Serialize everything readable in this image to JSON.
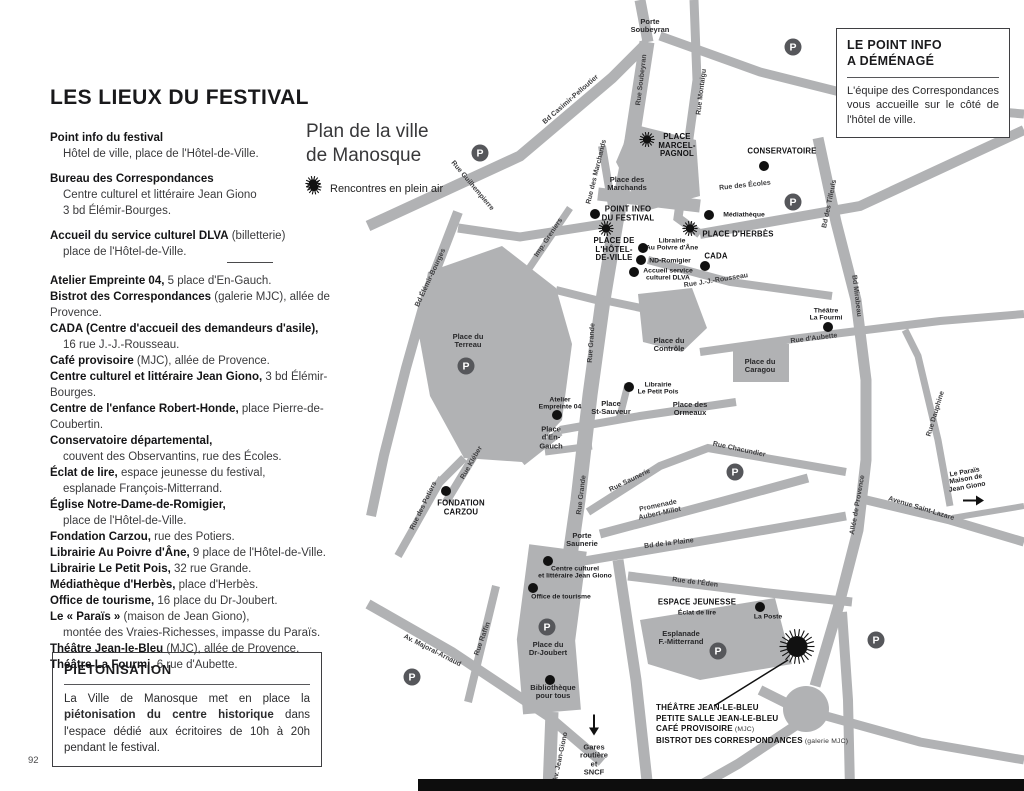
{
  "page": {
    "number": "92"
  },
  "left_column": {
    "title": "LES LIEUX DU FESTIVAL",
    "top_groups": [
      {
        "lines": [
          {
            "b": "Point info du festival",
            "r": ""
          },
          {
            "b": "",
            "r": "Hôtel de ville, place de l'Hôtel-de-Ville.",
            "indent": true
          }
        ]
      },
      {
        "lines": [
          {
            "b": "Bureau des Correspondances",
            "r": ""
          },
          {
            "b": "",
            "r": "Centre culturel et littéraire Jean Giono",
            "indent": true
          },
          {
            "b": "",
            "r": "3 bd Élémir-Bourges.",
            "indent": true
          }
        ]
      },
      {
        "lines": [
          {
            "b": "Accueil du service culturel DLVA",
            "r": " (billetterie)"
          },
          {
            "b": "",
            "r": "place de l'Hôtel-de-Ville.",
            "indent": true
          }
        ]
      }
    ],
    "venue_lines": [
      {
        "b": "Atelier Empreinte 04,",
        "r": " 5 place d'En-Gauch."
      },
      {
        "b": "Bistrot des Correspondances",
        "r": " (galerie MJC), allée de Provence."
      },
      {
        "b": "CADA (Centre d'accueil des demandeurs d'asile),",
        "r": ""
      },
      {
        "b": "",
        "r": "16 rue J.-J.-Rousseau.",
        "indent": true
      },
      {
        "b": "Café provisoire",
        "r": " (MJC), allée de Provence."
      },
      {
        "b": "Centre culturel et littéraire Jean Giono,",
        "r": " 3 bd Élémir-Bourges."
      },
      {
        "b": "Centre de l'enfance Robert-Honde,",
        "r": " place Pierre-de-Coubertin."
      },
      {
        "b": "Conservatoire départemental,",
        "r": ""
      },
      {
        "b": "",
        "r": "couvent des Observantins, rue des Écoles.",
        "indent": true
      },
      {
        "b": "Éclat de lire,",
        "r": " espace jeunesse du festival,"
      },
      {
        "b": "",
        "r": "esplanade François-Mitterrand.",
        "indent": true
      },
      {
        "b": "Église Notre-Dame-de-Romigier,",
        "r": ""
      },
      {
        "b": "",
        "r": "place de l'Hôtel-de-Ville.",
        "indent": true
      },
      {
        "b": "Fondation Carzou,",
        "r": " rue des Potiers."
      },
      {
        "b": "Librairie Au Poivre d'Âne,",
        "r": " 9 place de l'Hôtel-de-Ville."
      },
      {
        "b": "Librairie Le Petit Pois,",
        "r": " 32 rue Grande."
      },
      {
        "b": "Médiathèque d'Herbès,",
        "r": " place d'Herbès."
      },
      {
        "b": "Office de tourisme,",
        "r": " 16 place du Dr-Joubert."
      },
      {
        "b": "Le « Paraïs »",
        "r": " (maison de Jean Giono),"
      },
      {
        "b": "",
        "r": "montée des Vraies-Richesses, impasse du Paraïs.",
        "indent": true
      },
      {
        "b": "Théâtre Jean-le-Bleu",
        "r": " (MJC), allée de Provence."
      },
      {
        "b": "Théâtre La Fourmi,",
        "r": " 6 rue d'Aubette."
      }
    ]
  },
  "map_heading": {
    "title": "Plan de la ville\nde Manosque",
    "legend_label": "Rencontres en plein air"
  },
  "info_box": {
    "title": "LE POINT INFO\nA DÉMÉNAGÉ",
    "body": "L'équipe des Correspondances vous accueille sur le côté de l'hôtel de ville."
  },
  "pieton_box": {
    "title": "PIÉTONISATION",
    "body_pre": "La Ville de Manosque met en place la ",
    "body_bold": "piétonisation du centre historique",
    "body_post": " dans l'espace dédié aux écritoires de 10h à 20h pendant le festival."
  },
  "map": {
    "road_color": "#b1b2b4",
    "labels": [
      {
        "t": "Porte\nSoubeyran",
        "x": 650,
        "y": 26,
        "r": 0,
        "c": "place"
      },
      {
        "t": "Rue Soubeyran",
        "x": 642,
        "y": 80,
        "r": -83,
        "c": "street"
      },
      {
        "t": "Rue Montaigu",
        "x": 702,
        "y": 92,
        "r": -83,
        "c": "street"
      },
      {
        "t": "Bd Casimir-Pelloutier",
        "x": 571,
        "y": 100,
        "r": -41,
        "c": "street"
      },
      {
        "t": "Rue Guilhempierre",
        "x": 472,
        "y": 186,
        "r": 50,
        "c": "street"
      },
      {
        "t": "Rue des Marchands",
        "x": 597,
        "y": 172,
        "r": -76,
        "c": "street"
      },
      {
        "t": "Rue des Écoles",
        "x": 745,
        "y": 186,
        "r": -6,
        "c": "street"
      },
      {
        "t": "Imp. Greniers",
        "x": 549,
        "y": 238,
        "r": -56,
        "c": "street"
      },
      {
        "t": "Bd Élémir-Bourges",
        "x": 431,
        "y": 278,
        "r": -65,
        "c": "street"
      },
      {
        "t": "Rue J.-J.-Rousseau",
        "x": 716,
        "y": 281,
        "r": -9,
        "c": "street"
      },
      {
        "t": "Bd des Tilleuls",
        "x": 830,
        "y": 204,
        "r": -78,
        "c": "street"
      },
      {
        "t": "Bd Mirabeau",
        "x": 856,
        "y": 296,
        "r": 83,
        "c": "street"
      },
      {
        "t": "Rue d'Aubette",
        "x": 814,
        "y": 339,
        "r": -7,
        "c": "street"
      },
      {
        "t": "Rue Grande",
        "x": 592,
        "y": 343,
        "r": -86,
        "c": "street"
      },
      {
        "t": "Rue Grande",
        "x": 582,
        "y": 495,
        "r": -83,
        "c": "street"
      },
      {
        "t": "Rue Chacundier",
        "x": 739,
        "y": 450,
        "r": 12,
        "c": "street"
      },
      {
        "t": "Rue Saunerie",
        "x": 630,
        "y": 481,
        "r": -26,
        "c": "street"
      },
      {
        "t": "Rue Kléber",
        "x": 472,
        "y": 463,
        "r": -60,
        "c": "street"
      },
      {
        "t": "Rue des Potiers",
        "x": 424,
        "y": 506,
        "r": -64,
        "c": "street"
      },
      {
        "t": "Promenade\nAubert-Millot",
        "x": 659,
        "y": 510,
        "r": -12,
        "c": "street"
      },
      {
        "t": "Bd de la Plaine",
        "x": 669,
        "y": 544,
        "r": -7,
        "c": "street"
      },
      {
        "t": "Rue Dauphine",
        "x": 936,
        "y": 414,
        "r": -73,
        "c": "street"
      },
      {
        "t": "Avenue Saint-Lazare",
        "x": 921,
        "y": 509,
        "r": 17,
        "c": "street"
      },
      {
        "t": "Allée de Provence",
        "x": 858,
        "y": 505,
        "r": -80,
        "c": "street"
      },
      {
        "t": "Rue de l'Éden",
        "x": 695,
        "y": 583,
        "r": 7,
        "c": "street"
      },
      {
        "t": "Av. Majoral-Arnaud",
        "x": 432,
        "y": 651,
        "r": 27,
        "c": "street"
      },
      {
        "t": "Rue Raffin",
        "x": 483,
        "y": 639,
        "r": -70,
        "c": "street"
      },
      {
        "t": "Av. Jean-Giono",
        "x": 561,
        "y": 757,
        "r": -78,
        "c": "street"
      },
      {
        "t": "Place des\nMarchands",
        "x": 627,
        "y": 184,
        "r": 0,
        "c": "place"
      },
      {
        "t": "Place du\nTerreau",
        "x": 468,
        "y": 341,
        "r": 0,
        "c": "place"
      },
      {
        "t": "Place du\nContrôle",
        "x": 669,
        "y": 345,
        "r": 0,
        "c": "place"
      },
      {
        "t": "Place du\nCaragou",
        "x": 760,
        "y": 366,
        "r": 0,
        "c": "place"
      },
      {
        "t": "Place des\nOrmeaux",
        "x": 690,
        "y": 409,
        "r": 0,
        "c": "place"
      },
      {
        "t": "Place\nSt-Sauveur",
        "x": 611,
        "y": 408,
        "r": 0,
        "c": "place"
      },
      {
        "t": "Place\nd'En-\nGauch",
        "x": 551,
        "y": 438,
        "r": 0,
        "c": "place"
      },
      {
        "t": "Porte\nSaunerie",
        "x": 582,
        "y": 540,
        "r": 0,
        "c": "place"
      },
      {
        "t": "Place du\nDr-Joubert",
        "x": 548,
        "y": 649,
        "r": 0,
        "c": "place"
      },
      {
        "t": "Esplanade\nF.-Mitterrand",
        "x": 681,
        "y": 638,
        "r": 0,
        "c": "place"
      },
      {
        "t": "Bibliothèque\npour tous",
        "x": 553,
        "y": 692,
        "r": 0,
        "c": "place"
      },
      {
        "t": "Gares\nroutière\net\nSNCF",
        "x": 594,
        "y": 760,
        "r": 0,
        "c": "place"
      },
      {
        "t": "La Poste",
        "x": 768,
        "y": 617,
        "r": 0,
        "c": "poi"
      },
      {
        "t": "Médiathèque",
        "x": 744,
        "y": 215,
        "r": 0,
        "c": "poi"
      },
      {
        "t": "Librairie\nAu Poivre d'Âne",
        "x": 672,
        "y": 245,
        "r": 0,
        "c": "poi"
      },
      {
        "t": "ND-Romigier",
        "x": 670,
        "y": 261,
        "r": 0,
        "c": "poi"
      },
      {
        "t": "Accueil service\nculturel DLVA",
        "x": 668,
        "y": 275,
        "r": 0,
        "c": "poi"
      },
      {
        "t": "Librairie\nLe Petit Pois",
        "x": 658,
        "y": 389,
        "r": 0,
        "c": "poi"
      },
      {
        "t": "Atelier\nEmpreinte 04",
        "x": 560,
        "y": 404,
        "r": 0,
        "c": "poi"
      },
      {
        "t": "Théâtre\nLa Fourmi",
        "x": 826,
        "y": 315,
        "r": 0,
        "c": "poi"
      },
      {
        "t": "Centre culturel\net littéraire Jean Giono",
        "x": 575,
        "y": 573,
        "r": 0,
        "c": "poi"
      },
      {
        "t": "Office de tourisme",
        "x": 561,
        "y": 597,
        "r": 0,
        "c": "poi"
      },
      {
        "t": "Le Paraïs\nMaison de\nJean Giono",
        "x": 966,
        "y": 480,
        "r": -10,
        "c": "poi"
      },
      {
        "t": "PLACE\nMARCEL-\nPAGNOL",
        "x": 677,
        "y": 146,
        "r": 0,
        "c": "big"
      },
      {
        "t": "CONSERVATOIRE",
        "x": 782,
        "y": 152,
        "r": 0,
        "c": "big"
      },
      {
        "t": "POINT INFO\nDU FESTIVAL",
        "x": 628,
        "y": 214,
        "r": 0,
        "c": "big"
      },
      {
        "t": "PLACE DE\nL'HÔTEL-\nDE-VILLE",
        "x": 614,
        "y": 250,
        "r": 0,
        "c": "big"
      },
      {
        "t": "PLACE D'HERBÈS",
        "x": 738,
        "y": 235,
        "r": 0,
        "c": "big"
      },
      {
        "t": "CADA",
        "x": 716,
        "y": 257,
        "r": 0,
        "c": "big"
      },
      {
        "t": "FONDATION\nCARZOU",
        "x": 461,
        "y": 508,
        "r": 0,
        "c": "big"
      },
      {
        "t": "ESPACE JEUNESSE",
        "x": 697,
        "y": 603,
        "r": 0,
        "c": "big"
      },
      {
        "t": "Éclat de lire",
        "x": 697,
        "y": 613,
        "r": 0,
        "c": "poi"
      }
    ],
    "markers": [
      {
        "type": "parking",
        "x": 793,
        "y": 47
      },
      {
        "type": "parking",
        "x": 480,
        "y": 153
      },
      {
        "type": "parking",
        "x": 793,
        "y": 202
      },
      {
        "type": "parking",
        "x": 466,
        "y": 366
      },
      {
        "type": "parking",
        "x": 735,
        "y": 472
      },
      {
        "type": "parking",
        "x": 547,
        "y": 627
      },
      {
        "type": "parking",
        "x": 718,
        "y": 651
      },
      {
        "type": "parking",
        "x": 412,
        "y": 677
      },
      {
        "type": "parking",
        "x": 876,
        "y": 640
      },
      {
        "type": "dot",
        "x": 764,
        "y": 166
      },
      {
        "type": "dot",
        "x": 595,
        "y": 214
      },
      {
        "type": "dot",
        "x": 709,
        "y": 215
      },
      {
        "type": "dot",
        "x": 643,
        "y": 248
      },
      {
        "type": "dot",
        "x": 641,
        "y": 260
      },
      {
        "type": "dot",
        "x": 634,
        "y": 272
      },
      {
        "type": "dot",
        "x": 705,
        "y": 266
      },
      {
        "type": "dot",
        "x": 828,
        "y": 327
      },
      {
        "type": "dot",
        "x": 557,
        "y": 415
      },
      {
        "type": "dot",
        "x": 629,
        "y": 387
      },
      {
        "type": "dot",
        "x": 446,
        "y": 491
      },
      {
        "type": "dot",
        "x": 548,
        "y": 561
      },
      {
        "type": "dot",
        "x": 533,
        "y": 588
      },
      {
        "type": "dot",
        "x": 760,
        "y": 607
      },
      {
        "type": "dot",
        "x": 550,
        "y": 680
      },
      {
        "type": "sun",
        "x": 313,
        "y": 186
      },
      {
        "type": "sun",
        "x": 647,
        "y": 142
      },
      {
        "type": "sun",
        "x": 606,
        "y": 231
      },
      {
        "type": "sun",
        "x": 690,
        "y": 231
      },
      {
        "type": "sun-big",
        "x": 797,
        "y": 649
      },
      {
        "type": "arrow-down",
        "x": 594,
        "y": 727
      },
      {
        "type": "arrow-right",
        "x": 973,
        "y": 503
      }
    ],
    "theatre_callout": [
      {
        "b": "THÉÂTRE JEAN-LE-BLEU",
        "r": ""
      },
      {
        "b": "PETITE SALLE JEAN-LE-BLEU",
        "r": ""
      },
      {
        "b": "CAFÉ PROVISOIRE",
        "r": " (MJC)"
      },
      {
        "b": "BISTROT DES CORRESPONDANCES",
        "r": " (galerie MJC)"
      }
    ]
  }
}
